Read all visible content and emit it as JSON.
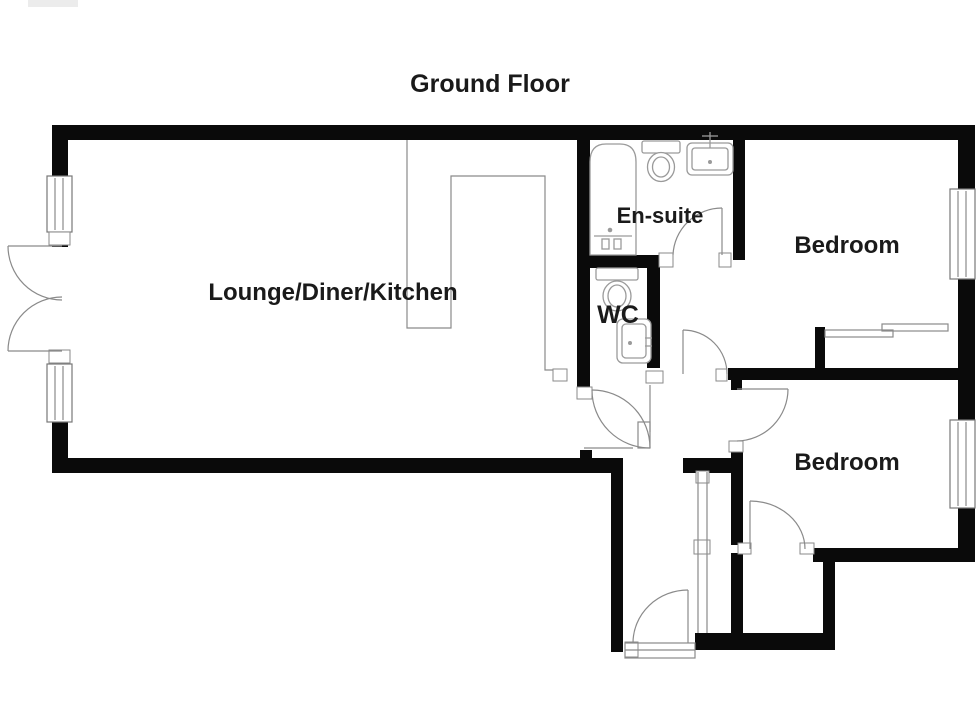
{
  "title": "Ground Floor",
  "rooms": {
    "lounge": {
      "label": "Lounge/Diner/Kitchen"
    },
    "ensuite": {
      "label": "En-suite"
    },
    "wc": {
      "label": "WC"
    },
    "bedroom_top": {
      "label": "Bedroom"
    },
    "bedroom_bottom": {
      "label": "Bedroom"
    }
  },
  "colors": {
    "wall": "#0a0a0a",
    "line": "#8a8a8a",
    "fixture": "#9a9a9a",
    "text": "#1a1a1a",
    "bg": "#ffffff"
  }
}
